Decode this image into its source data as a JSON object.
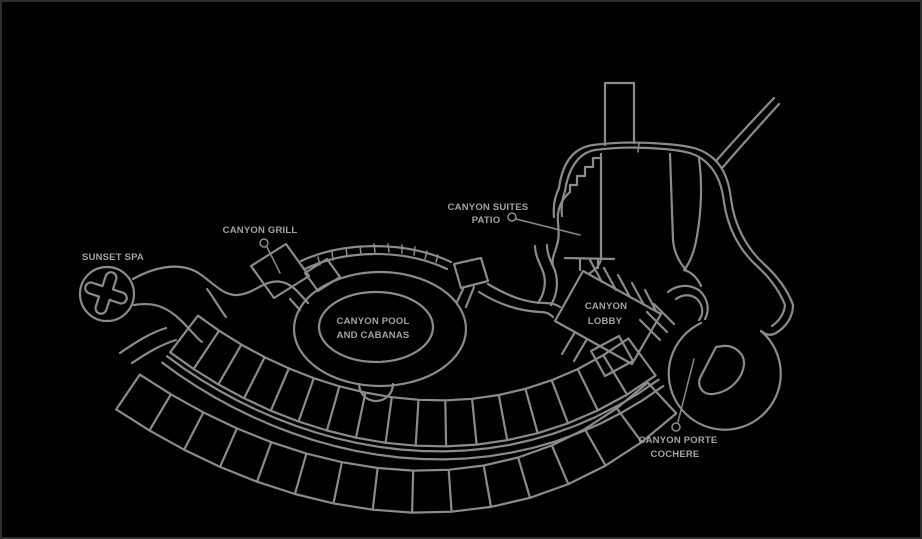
{
  "map": {
    "labels": {
      "sunset_spa": "SUNSET SPA",
      "canyon_grill": "CANYON GRILL",
      "canyon_pool_line1": "CANYON POOL",
      "canyon_pool_line2": "AND CABANAS",
      "canyon_suites_line1": "CANYON SUITES",
      "canyon_suites_line2": "PATIO",
      "canyon_lobby_line1": "CANYON",
      "canyon_lobby_line2": "LOBBY",
      "porte_cochere_line1": "CANYON PORTE",
      "porte_cochere_line2": "COCHERE"
    },
    "colors": {
      "background": "#000000",
      "line": "#8b8b8b",
      "label_text": "#a3a3a3",
      "border": "#2e2e2e"
    }
  }
}
